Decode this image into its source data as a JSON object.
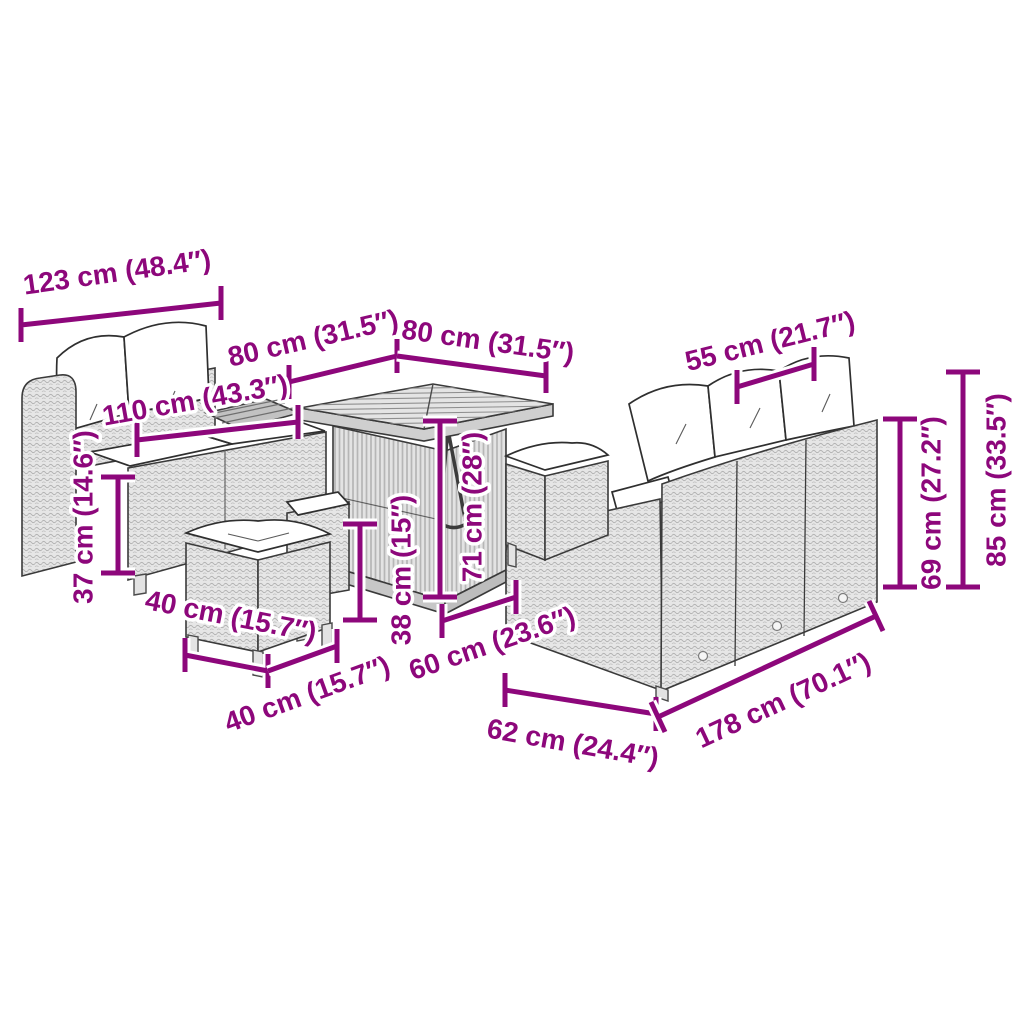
{
  "diagram": {
    "type": "furniture-dimension-diagram",
    "subject": "poly rattan garden lounge set with two sofas, cube table and ottomans",
    "background_color": "#ffffff",
    "accent_color": "#8d077b",
    "furniture_colors": {
      "rattan": "#e6e6e6",
      "cushion": "#ffffff",
      "outline": "#3a3a3a"
    },
    "dimensions": [
      {
        "id": "left-sofa-width",
        "label": "123 cm (48.4″)"
      },
      {
        "id": "table-depth",
        "label": "80 cm (31.5″)"
      },
      {
        "id": "table-width",
        "label": "80 cm (31.5″)"
      },
      {
        "id": "seat-cushion-width",
        "label": "55 cm (21.7″)"
      },
      {
        "id": "left-sofa-inner",
        "label": "110 cm (43.3″)"
      },
      {
        "id": "seat-height",
        "label": "37 cm (14.6″)"
      },
      {
        "id": "ottoman-width",
        "label": "40 cm (15.7″)"
      },
      {
        "id": "ottoman-depth",
        "label": "40 cm (15.7″)"
      },
      {
        "id": "ottoman-height",
        "label": "38 cm (15″)"
      },
      {
        "id": "table-height",
        "label": "71 cm (28″)"
      },
      {
        "id": "seat-depth",
        "label": "60 cm (23.6″)"
      },
      {
        "id": "right-sofa-depth",
        "label": "62 cm (24.4″)"
      },
      {
        "id": "right-sofa-width",
        "label": "178 cm (70.1″)"
      },
      {
        "id": "backrest-height",
        "label": "69 cm (27.2″)"
      },
      {
        "id": "total-height",
        "label": "85 cm (33.5″)"
      }
    ]
  }
}
